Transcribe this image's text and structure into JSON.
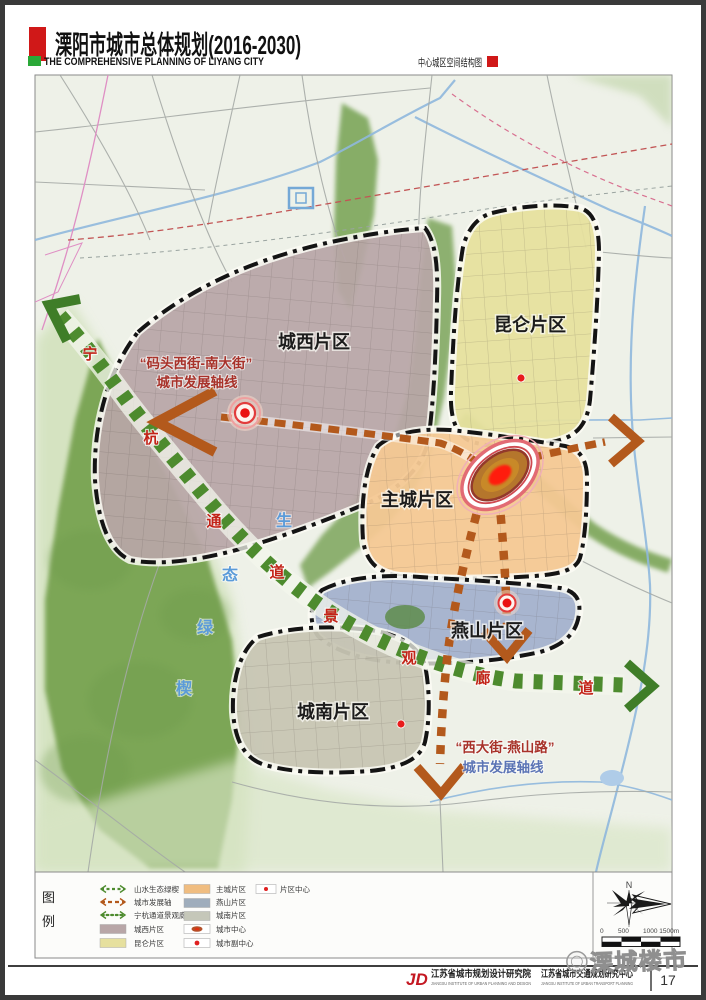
{
  "header": {
    "title": "溧阳市城市总体规划(2016-2030)",
    "subtitle_en": "THE COMPREHENSIVE PLANNING OF LIYANG CITY",
    "map_name": "中心城区空间结构图"
  },
  "map": {
    "districts": [
      {
        "id": "chengxi",
        "label": "城西片区",
        "color": "#b8a6a7"
      },
      {
        "id": "kunlun",
        "label": "昆仑片区",
        "color": "#e6e09e"
      },
      {
        "id": "zhucheng",
        "label": "主城片区",
        "color": "#f4c893"
      },
      {
        "id": "yanshan",
        "label": "燕山片区",
        "color": "#a3b0cc"
      },
      {
        "id": "chengnan",
        "label": "城南片区",
        "color": "#c7c5b3"
      }
    ],
    "axis_annotations": [
      {
        "line1": "“码头西街-南大街”",
        "line2": "城市发展轴线"
      },
      {
        "line1": "“西大街-燕山路”",
        "line2": "城市发展轴线"
      }
    ],
    "corridor_chars_ninghang": [
      "宁",
      "杭",
      "通",
      "道"
    ],
    "corridor_chars_jingguan": [
      "景",
      "观",
      "廊",
      "道"
    ],
    "wedge_chars": [
      "生",
      "态",
      "绿",
      "楔"
    ]
  },
  "legend": {
    "title_chars": [
      "图",
      "例"
    ],
    "col1": [
      {
        "label": "山水生态绿楔",
        "color": "#4d8b2e"
      },
      {
        "label": "城市发展轴",
        "color": "#b3591c"
      },
      {
        "label": "宁杭通道景观廊道",
        "color": "#4d8b2e"
      },
      {
        "label": "城西片区",
        "color": "#b8a6a7"
      },
      {
        "label": "昆仑片区",
        "color": "#e6e09e"
      }
    ],
    "col2": [
      {
        "label": "主城片区",
        "color": "#f0bd80"
      },
      {
        "label": "燕山片区",
        "color": "#9fadbc"
      },
      {
        "label": "城南片区",
        "color": "#c5c7b9"
      },
      {
        "label": "城市中心",
        "color": "#b4512a"
      },
      {
        "label": "城市副中心",
        "color": "#e02020"
      }
    ],
    "col3": [
      {
        "label": "片区中心",
        "color": "#e02020"
      }
    ],
    "north_label": "N",
    "scale_ticks": [
      "0",
      "500",
      "1000 1500m"
    ]
  },
  "footer": {
    "logo_text": "JD",
    "institute1_cn": "江苏省城市规划设计研究院",
    "institute1_en": "JIANGSU INSTITUTE OF URBAN PLANNING AND DESIGN",
    "institute2_cn": "江苏省城市交通规划研究中心",
    "institute2_en": "JIANGSU INSTITUTE OF URBAN TRANSPORT PLANNING",
    "page": "17",
    "watermark": "溧城楼市"
  },
  "colors": {
    "axis_brown": "#b3591c",
    "corridor_green": "#4d8b2e",
    "annotation_red": "#a8322a",
    "annotation_blue": "#5b74b5",
    "header_red": "#d01818",
    "header_green": "#2aa838"
  }
}
